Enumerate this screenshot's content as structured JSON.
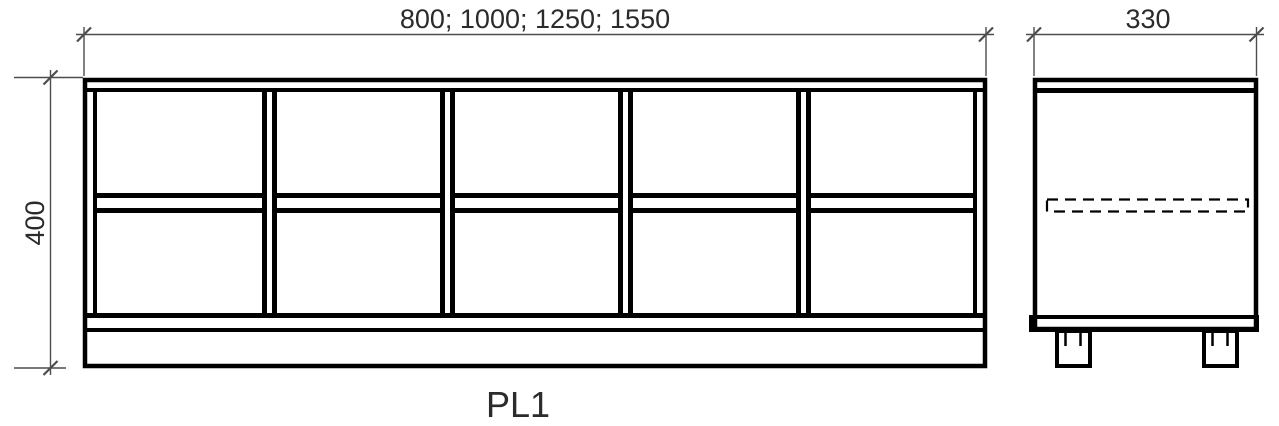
{
  "drawing": {
    "label": "PL1",
    "front_view": {
      "width_dimension": "800; 1000; 1250; 1550",
      "height_dimension": "400",
      "columns": 5,
      "shelf_rows": 2,
      "has_plinth": true
    },
    "side_view": {
      "depth_dimension": "330",
      "hidden_rail": "dashed",
      "legs": 2
    },
    "colors": {
      "background": "#ffffff",
      "line": "#000000",
      "dimension": "#4d4d4d",
      "text": "#2b2b2b"
    }
  }
}
